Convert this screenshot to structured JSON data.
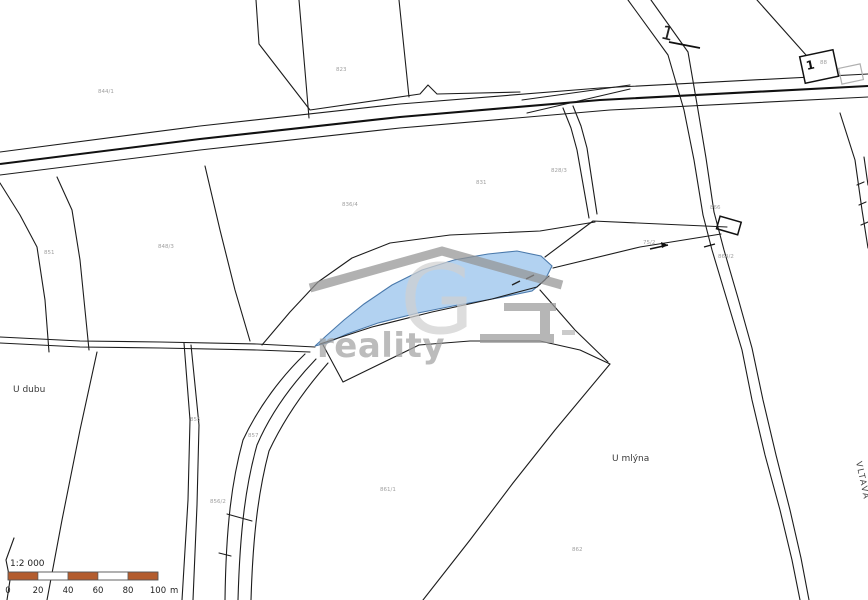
{
  "labels": {
    "u_dubu": "U dubu",
    "u_mlyna": "U mlýna",
    "vltava": "VLTAVA",
    "road_number": "1",
    "building_number": "1"
  },
  "watermark": {
    "brand_letter": "G",
    "brand_text": "reality"
  },
  "scalebar": {
    "ratio": "1:2 000",
    "unit": "m",
    "tick_labels": [
      "0",
      "20",
      "40",
      "60",
      "80",
      "100"
    ],
    "segment_count": 5,
    "bar_color": "#b35c2e",
    "bar_alt_color": "#ffffff"
  },
  "highlighted_parcel": {
    "fill_color": "#aacdf0",
    "stroke_color": "#4a79ab"
  },
  "illegible_parcel_numbers": [
    {
      "x": 98,
      "y": 93,
      "text": "844/1"
    },
    {
      "x": 336,
      "y": 71,
      "text": "823"
    },
    {
      "x": 342,
      "y": 206,
      "text": "836/4"
    },
    {
      "x": 476,
      "y": 184,
      "text": "831"
    },
    {
      "x": 551,
      "y": 172,
      "text": "828/3"
    },
    {
      "x": 44,
      "y": 254,
      "text": "851"
    },
    {
      "x": 158,
      "y": 248,
      "text": "848/3"
    },
    {
      "x": 190,
      "y": 421,
      "text": "855"
    },
    {
      "x": 210,
      "y": 503,
      "text": "856/2"
    },
    {
      "x": 380,
      "y": 491,
      "text": "861/1"
    },
    {
      "x": 572,
      "y": 551,
      "text": "862"
    },
    {
      "x": 643,
      "y": 244,
      "text": "75/2"
    },
    {
      "x": 710,
      "y": 209,
      "text": "866"
    },
    {
      "x": 820,
      "y": 64,
      "text": "88"
    },
    {
      "x": 248,
      "y": 437,
      "text": "857"
    },
    {
      "x": 718,
      "y": 258,
      "text": "864/2"
    }
  ]
}
